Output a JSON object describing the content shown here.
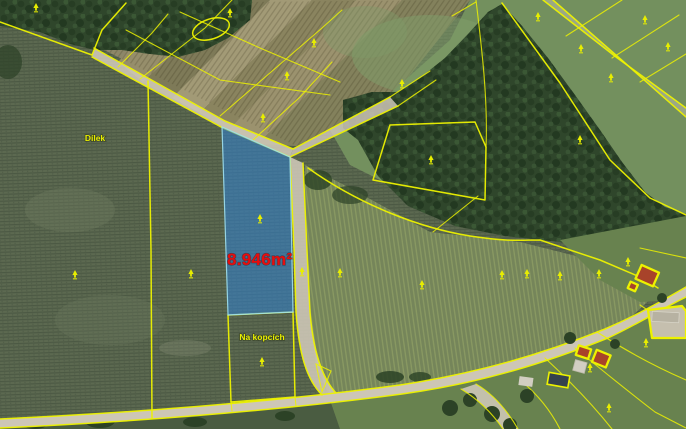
{
  "map": {
    "type": "cadastral-parcel-map-aerial",
    "highlighted_parcel": {
      "area_label": "8.946m²",
      "fill_color": "#2f82d4",
      "outline_color": "#9fe0ef",
      "label_color": "#e80d0d"
    },
    "field_labels": [
      {
        "text": "Dílek",
        "x": 95,
        "y": 141
      },
      {
        "text": "Na kopcích",
        "x": 262,
        "y": 340
      }
    ],
    "colors": {
      "boundary_yellow": "#edf200",
      "label_yellow": "#e8ee00",
      "area_red": "#e80d0d",
      "road_surface": "#cdc6b6",
      "field_green": "#5c6950",
      "darkfield_green": "#4a5c41",
      "forest_green": "#2f462b",
      "dark_scrub": "#2c4226",
      "meadow_green": "#73905e",
      "lawn_green": "#68824f",
      "strip_tan": "#8d8768",
      "roof_red": "#a8432a",
      "yard_pale": "#c5bfae",
      "building_dark": "#35424d",
      "building_light": "#d2cec2"
    },
    "markers": {
      "symbol": "land-use-marker",
      "positions": [
        [
          36,
          8
        ],
        [
          230,
          13
        ],
        [
          314,
          43
        ],
        [
          287,
          76
        ],
        [
          263,
          118
        ],
        [
          402,
          84
        ],
        [
          431,
          160
        ],
        [
          538,
          17
        ],
        [
          581,
          49
        ],
        [
          611,
          78
        ],
        [
          645,
          20
        ],
        [
          668,
          47
        ],
        [
          580,
          140
        ],
        [
          75,
          275
        ],
        [
          191,
          274
        ],
        [
          260,
          219
        ],
        [
          302,
          272
        ],
        [
          340,
          273
        ],
        [
          422,
          285
        ],
        [
          502,
          275
        ],
        [
          527,
          274
        ],
        [
          560,
          276
        ],
        [
          599,
          274
        ],
        [
          628,
          262
        ],
        [
          262,
          362
        ],
        [
          646,
          343
        ],
        [
          609,
          408
        ],
        [
          590,
          368
        ]
      ]
    }
  }
}
